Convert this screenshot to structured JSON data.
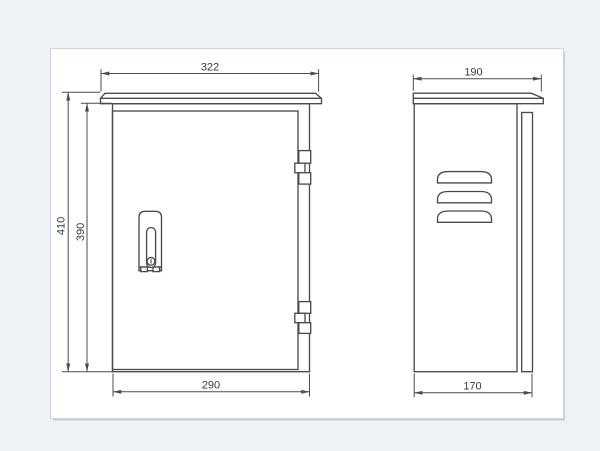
{
  "canvas": {
    "background_color": "#eef2f7",
    "sheet_color": "#ffffff",
    "sheet_border_color": "#cfd5de",
    "line_color": "#4b4b4b",
    "text_color": "#3a3a3a"
  },
  "front_view": {
    "dim_roof_width": "322",
    "dim_overall_height": "410",
    "dim_body_height": "390",
    "dim_body_width": "290"
  },
  "side_view": {
    "dim_roof_depth": "190",
    "dim_body_depth": "170"
  }
}
